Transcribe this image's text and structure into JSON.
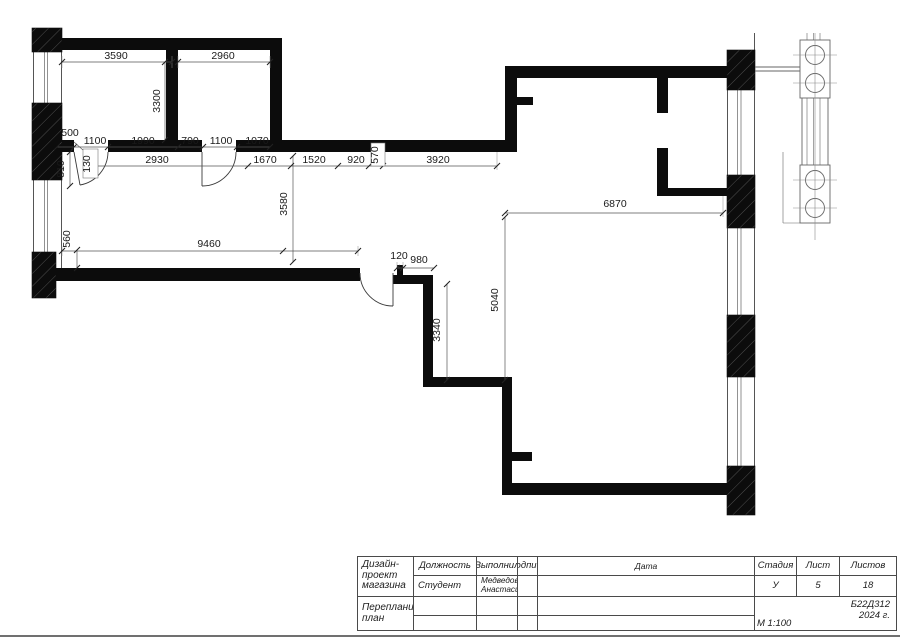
{
  "plan": {
    "dims": {
      "top_a": "3590",
      "top_b": "2960",
      "room_h": "3300",
      "c1_500": "500",
      "c1_1100a": "1100",
      "c1_1990": "1990",
      "c1_790": "790",
      "c1_1100b": "1100",
      "c1_1070": "1070",
      "box_130": "130",
      "v_810": "810",
      "c2_2930": "2930",
      "c2_1670": "1670",
      "c2_1520": "1520",
      "c2_920": "920",
      "box_570": "570",
      "c2_3920": "3920",
      "v_3580": "3580",
      "v_560": "560",
      "long_9460": "9460",
      "d_120": "120",
      "d_980": "980",
      "v_3340": "3340",
      "v_5040": "5040",
      "h_6870": "6870"
    }
  },
  "title_block": {
    "col_position": "Должность",
    "col_executed": "Выполнил",
    "col_signature": "Подпись",
    "col_date": "Дата",
    "project": "Дизайн-проект магазина",
    "col_stage": "Стадия",
    "col_sheet": "Лист",
    "col_sheets": "Листов",
    "row_role": "Студент",
    "name_line1": "Медведовская",
    "name_line2": "Анастасия",
    "stage_value": "У",
    "sheet_value": "5",
    "sheets_value": "18",
    "drawing_title": "Перепланировочный план",
    "code": "Б22Д312",
    "year": "2024 г.",
    "scale": "М 1:100"
  }
}
